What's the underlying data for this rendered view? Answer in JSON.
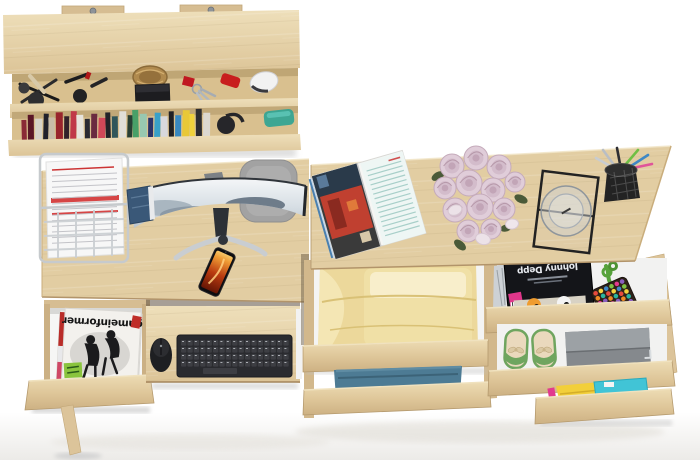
{
  "meta": {
    "description": "Top-down 3D product render of a Sonoma oak home-office desk set: wall shelf with books and cosmetics, computer desk with curved monitor and pull-out keyboard tray, and a second desk with open storage drawers",
    "background_color": "#ffffff"
  },
  "palette": {
    "wood_light": "#eedfba",
    "wood_mid": "#e2cda2",
    "wood_dark": "#c9ac79",
    "drawer_interior": "#f4f4f3",
    "shadow": "#d9d9d9"
  },
  "wall_shelf": {
    "label": "wall-mounted shelf with cosmetics and books",
    "items": [
      "makeup brushes",
      "lipsticks",
      "powder compact",
      "wicker basket",
      "black box",
      "keys with red fob",
      "red pocket knife",
      "white computer mouse",
      "row of books",
      "black headphones",
      "teal case"
    ],
    "book_colors": [
      "#8a2a36",
      "#5a1626",
      "#d6d2c8",
      "#20202a",
      "#c8bca8",
      "#98242c",
      "#32222a",
      "#c03848",
      "#e8e4dc",
      "#2a2a32",
      "#6a2a40",
      "#d04858",
      "#222228",
      "#30565a",
      "#e0ded8",
      "#283e34",
      "#48a068",
      "#98c8b0",
      "#2a3268",
      "#38a0c8",
      "#d8d8dc",
      "#202024",
      "#3888c0",
      "#e8c838",
      "#f0d23c",
      "#2c2c30",
      "#dcd8d0"
    ]
  },
  "left_desk": {
    "label": "computer desk",
    "paper_tray": {
      "label": "wire letter tray with printed documents",
      "accent_color": "#cc3434"
    },
    "notebook": {
      "label": "blue notebook",
      "color": "#3a5878"
    },
    "monitor": {
      "label": "curved widescreen monitor",
      "wallpaper": "snowy mountains",
      "bezel_color": "#2f343a"
    },
    "chair": {
      "label": "gray desk chair backrest",
      "color": "#a2a2a2"
    },
    "phone": {
      "label": "smartphone with flame wallpaper",
      "screen_colors": [
        "#651605",
        "#b93a10",
        "#ef9c35"
      ]
    },
    "keyboard_tray": {
      "label": "pull-out keyboard shelf",
      "keyboard_color": "#2a2b2f",
      "mouse_color": "#1e1f22"
    },
    "magazine_drawer": {
      "label": "open drawer with magazine stack",
      "magazine_title": "gameinformer",
      "sticker_color": "#8ac43e"
    }
  },
  "right_desk": {
    "label": "desk with storage drawers",
    "open_magazine": {
      "label": "open magazine with red street photo"
    },
    "roses": {
      "label": "bouquet of pale pink roses",
      "rose_color": "#e0cdd9",
      "loose_petals": 3
    },
    "glass_holder": {
      "label": "drinking glass in black wire stand"
    },
    "pen_cup": {
      "label": "black mesh pen cup",
      "pen_colors": [
        "#b9bec4",
        "#2e2e32",
        "#6fbf44",
        "#3f88c5",
        "#c8ccd0",
        "#e0559a"
      ]
    },
    "drawers": [
      {
        "contents": "folded yellow clothes",
        "color": "#ecd89b"
      },
      {
        "contents": "folded blue clothes",
        "color": "#4d7b94"
      },
      {
        "contents": "magazines and beaded bag",
        "magazine_title": "Johnny Depp",
        "bead_colors": [
          "#e84b3c",
          "#f5d33c",
          "#3f88c5",
          "#7dc242",
          "#e23a8e",
          "#8a5fc0",
          "#f08a24",
          "#2ab5a0"
        ],
        "strap_color": "#57a23b"
      },
      {
        "contents": "green ballet flats and gray case"
      },
      {
        "contents": "yellow and cyan clothes"
      }
    ]
  }
}
